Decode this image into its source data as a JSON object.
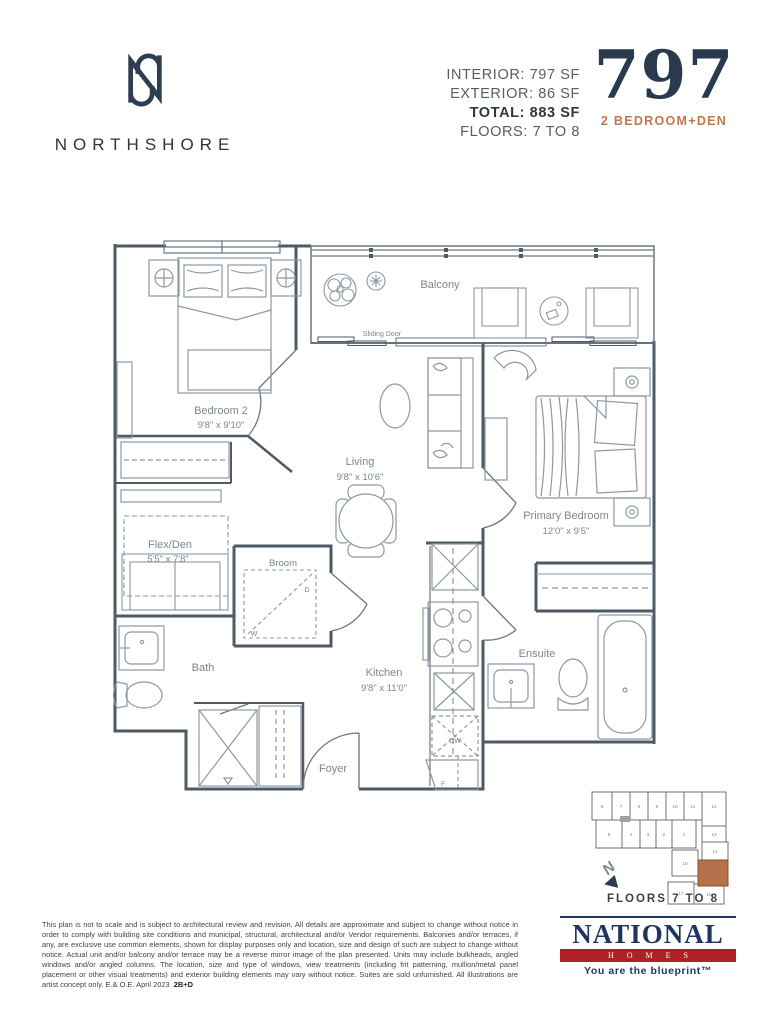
{
  "header": {
    "brand": "NORTHSHORE",
    "stats_lines": [
      "INTERIOR: 797 SF",
      "EXTERIOR: 86 SF",
      "TOTAL: 883 SF",
      "FLOORS: 7 TO 8"
    ],
    "unit_number": "797",
    "unit_type": "2 BEDROOM+DEN"
  },
  "plan": {
    "rooms": {
      "bedroom2": {
        "name": "Bedroom 2",
        "dims": "9'8\" x 9'10\""
      },
      "living": {
        "name": "Living",
        "dims": "9'8\" x 10'6\""
      },
      "primary": {
        "name": "Primary Bedroom",
        "dims": "12'0\" x 9'5\""
      },
      "flexden": {
        "name": "Flex/Den",
        "dims": "5'5\" x 7'8\""
      },
      "kitchen": {
        "name": "Kitchen",
        "dims": "9'8\" x 11'0\""
      },
      "broom": {
        "name": "Broom"
      },
      "bath": {
        "name": "Bath"
      },
      "ensuite": {
        "name": "Ensuite"
      },
      "foyer": {
        "name": "Foyer"
      },
      "balcony": {
        "name": "Balcony"
      },
      "sliding_door": {
        "name": "Sliding Door"
      }
    },
    "appliances": {
      "washer": "W",
      "dryer": "D",
      "dishwasher": "DW",
      "fridge": "F"
    }
  },
  "keyplan": {
    "caption": "FLOORS 7 TO 8",
    "north": "N",
    "highlighted_unit": "15",
    "units": [
      "1",
      "2",
      "3",
      "4",
      "5",
      "6",
      "7",
      "8",
      "9",
      "10",
      "11",
      "12",
      "13",
      "14",
      "15",
      "16",
      "17",
      "18"
    ]
  },
  "footer": {
    "disclaimer": "This plan is not to scale and is subject to architectural review and revision. All details are approximate and subject to change without notice in order to comply with building site conditions and municipal, structural, architectural and/or Vendor requirements. Balconies and/or terraces, if any, are exclusive use common elements, shown for display purposes only and location, size and design of such are subject to change without notice. Actual unit and/or balcony and/or terrace may be a reverse mirror image of the plan presented. Units may include bulkheads, angled windows and/or angled columns. The location, size and type of windows, view treatments (including frit patterning, mullion/metal panel placement or other visual treatments) and exterior building elements may vary without notice. Suites are sold unfurnished. All illustrations are artist concept only. E.& O.E. April 2023",
    "plan_code": "2B+D",
    "logo": {
      "name": "NATIONAL",
      "sub": "HOMES",
      "tagline": "You are the blueprint™"
    }
  },
  "colors": {
    "navy": "#2d3e50",
    "orange": "#c0784a",
    "wall": "#4e5b66",
    "furniture": "#8e98a0",
    "label": "#7a8791",
    "national_navy": "#1e355e",
    "national_red": "#af2126",
    "keyplan_highlight": "#b5714a"
  }
}
